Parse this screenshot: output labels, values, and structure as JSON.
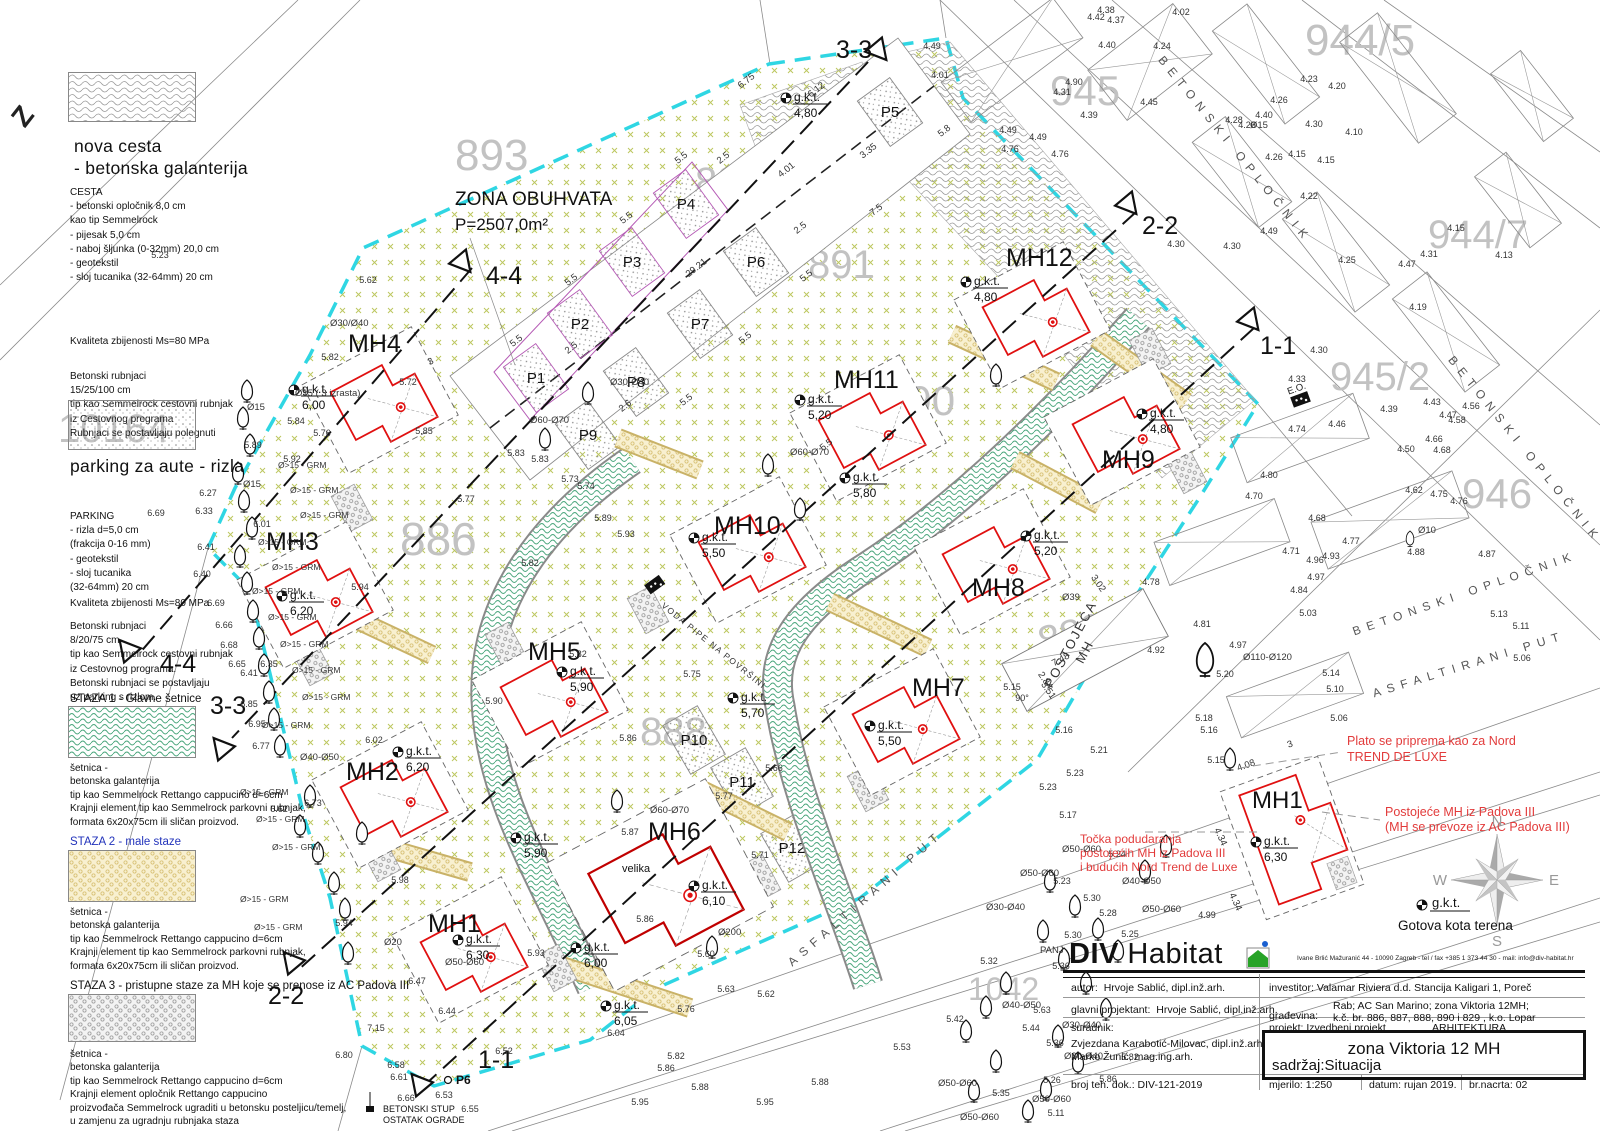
{
  "zone": {
    "line1": "ZONA OBUHVATA",
    "line2": "P=2507,0m²"
  },
  "legend": {
    "road_title_1": "nova cesta",
    "road_title_2": "- betonska galanterija",
    "cesta": [
      "CESTA",
      "- betonski opločnik 8,0 cm",
      "kao tip Semmelrock",
      "- pijesak 5,0 cm",
      "- naboj šljunka (0-32mm) 20,0 cm",
      "- geotekstil",
      "- sloj tucanika (32-64mm) 20 cm"
    ],
    "quality_road": "Kvaliteta zbijenosti Ms=80 MPa",
    "rubnjaci_road": [
      "Betonski rubnjaci",
      "15/25/100 cm",
      "tip kao Semmelrock cestovni rubnjak",
      "iz Cestovnog programa",
      "Rubnjaci se postavljaju polegnuti"
    ],
    "parking_title": "parking za aute - rizla",
    "parking": [
      "PARKING",
      "- rizla d=5,0 cm",
      "(frakcija 0-16 mm)",
      "- geotekstil",
      "- sloj tucanika",
      "(32-64mm) 20 cm"
    ],
    "quality_parking": "Kvaliteta zbijenosti Ms=80 MPa",
    "rubnjaci_parking": [
      "Betonski rubnjaci",
      "8/20/75 cm",
      "tip kao Semmelrock cestovni rubnjak",
      "iz Cestovnog programa.",
      "Betonski rubnjaci se postavljaju",
      "uz parking s rizlom."
    ],
    "staza1_title": "STAZA 1  - Glavne šetnice",
    "staza1": [
      "šetnica -",
      "betonska galanterija",
      "tip kao Semmelrock Rettango cappucino d=6cm",
      "Krajnji element tip kao Semmelrock parkovni rubnjak,",
      "formata 6x20x75cm ili sličan proizvod."
    ],
    "staza2_title": "STAZA 2 - male staze",
    "staza2": [
      "šetnica -",
      "betonska galanterija",
      "tip kao Semmelrock Rettango cappucino d=6cm",
      "Krajnji element tip kao Semmelrock parkovni rubnjak,",
      "formata 6x20x75cm ili sličan proizvod."
    ],
    "staza3_title": "STAZA 3 - pristupne staze za MH koje se prenose iz AC Padova III",
    "staza3": [
      "šetnica -",
      "betonska galanterija",
      "tip kao Semmelrock Rettango cappucino d=6cm",
      "Krajnji element opločnik Rettango cappucino",
      "proizvođača Semmelrock ugraditi u betonsku posteljicu/temelj,",
      "u zamjenu za ugradnju rubnjaka staza"
    ]
  },
  "mh_units": [
    {
      "label": "MH4",
      "gkt": "6,00"
    },
    {
      "label": "MH3",
      "gkt": "6,20"
    },
    {
      "label": "MH2",
      "gkt": "6,20"
    },
    {
      "label": "MH1",
      "gkt": "6,30"
    },
    {
      "label": "MH5",
      "gkt": "5,90"
    },
    {
      "label": "MH6",
      "gkt": "6,10",
      "note": "velika"
    },
    {
      "label": "MH10",
      "gkt": "5,50"
    },
    {
      "label": "MH11",
      "gkt": "5,20"
    },
    {
      "label": "MH12",
      "gkt": "4,80"
    },
    {
      "label": "MH9",
      "gkt": "4,80"
    },
    {
      "label": "MH8",
      "gkt": "5,20"
    },
    {
      "label": "MH7",
      "gkt": "5,50"
    }
  ],
  "detail": {
    "label": "MH1",
    "gkt": "6,30"
  },
  "gkt_label": "g.k.t.",
  "gkt_points": [
    [
      "4,80",
      786,
      98
    ],
    [
      "5,80",
      845,
      478
    ],
    [
      "5,70",
      733,
      698
    ],
    [
      "5,90",
      516,
      838
    ],
    [
      "6,00",
      576,
      948
    ],
    [
      "6,05",
      606,
      1006
    ],
    [
      "6,30",
      1256,
      842
    ]
  ],
  "parking_stalls": [
    "P1",
    "P2",
    "P3",
    "P4",
    "P5",
    "P6",
    "P7",
    "P8",
    "P9",
    "P10",
    "P11",
    "P12"
  ],
  "parcels": [
    [
      "893",
      455,
      170,
      44,
      0
    ],
    [
      "892",
      695,
      195,
      40,
      0
    ],
    [
      "891",
      808,
      278,
      40,
      0
    ],
    [
      "890",
      885,
      415,
      42,
      0
    ],
    [
      "886",
      400,
      555,
      46,
      0
    ],
    [
      "889",
      1042,
      655,
      40,
      -14
    ],
    [
      "888",
      640,
      745,
      40,
      0
    ],
    [
      "10164",
      58,
      442,
      40,
      0
    ],
    [
      "1042",
      968,
      1000,
      32,
      0
    ],
    [
      "944/5",
      1305,
      55,
      44,
      0
    ],
    [
      "945",
      1050,
      105,
      42,
      0
    ],
    [
      "945/2",
      1330,
      390,
      40,
      0
    ],
    [
      "944/7",
      1428,
      248,
      40,
      0
    ],
    [
      "946",
      1462,
      508,
      42,
      0
    ]
  ],
  "roads": {
    "betonski": "BETONSKI OPLOČNIK",
    "asfaltirani": "ASFALTIRANI PUT",
    "postojeca1": "POSTOJEĆA",
    "postojeca2": "MH"
  },
  "sections": {
    "s11": "1-1",
    "s22": "2-2",
    "s33": "3-3",
    "s44": "4-4"
  },
  "red_notes": {
    "plato1": "Plato se priprema kao za Nord",
    "plato2": "TREND DE LUXE",
    "post1": "Postojeće MH iz Padova III",
    "post2": "(MH se prevoze iz AC Padova III)",
    "tocka1": "Točka podudaranja",
    "tocka2": "postojećih MH iz Padova III",
    "tocka3": "i budućih Nord Trend de Luxe"
  },
  "misc": {
    "z": "Z",
    "voda": "VODA PIPE NA POVRŠINI",
    "eo": "E.O.",
    "stup1": "BETONSKI STUP",
    "stup2": "OSTATAK OGRADE",
    "p6": "P6",
    "gotova": "Gotova kota terena",
    "grm": "Ø>15 - GRM"
  },
  "compass": {
    "n": "N",
    "e": "E",
    "s": "S",
    "w": "W"
  },
  "titleblock": {
    "brand_bold": "DIV",
    "brand_light": "Habitat",
    "address": "Ivane Brlić Mažuranić 44 - 10090 Zagreb - tel / fax +385 1 373 44 30 - mail: info@div-habitat.hr",
    "autor_label": "autor:",
    "autor": "Hrvoje Sablić, dipl.inž.arh.",
    "investitor_label": "investitor:",
    "investitor": "Valamar Riviera d.d. Stancija Kaligari 1, Poreč",
    "gp_label": "glavni projektant:",
    "gp": "Hrvoje Sablić, dipl.inž.arh.",
    "gradjevina_label": "građevina:",
    "gradjevina1": "Rab; AC San Marino; zona Viktoria 12MH;",
    "gradjevina2": "k.č. br. 886, 887, 888, 890 i 829 , k.o.  Lopar",
    "suradnik_label": "suradnik:",
    "suradnik1": "Zvjezdana Karabotić-Milovac, dipl.inž.arh.",
    "suradnik2": "Marko Žunić, mag.ing.arh.",
    "projekt_label": "projekt: Izvedbeni projekt",
    "struka": "ARHITEKTURA",
    "naslov": "zona Viktoria 12 MH",
    "sadrzaj": "sadržaj:Situacija",
    "broj_label": "broj teh. dok.: DIV-121-2019",
    "mjerilo_label": "mjerilo:  1:250",
    "datum_label": "datum:  rujan  2019.",
    "nacrt_label": "br.nacrta:  02"
  },
  "spot_heights": [
    [
      "5.62",
      368,
      283
    ],
    [
      "5.82",
      330,
      360
    ],
    [
      "5.84",
      296,
      424
    ],
    [
      "5.72",
      408,
      385
    ],
    [
      "5.76",
      322,
      436
    ],
    [
      "5.85",
      424,
      434
    ],
    [
      "5.92",
      292,
      462
    ],
    [
      "5.89",
      253,
      448
    ],
    [
      "6.01",
      262,
      527
    ],
    [
      "6.27",
      208,
      496
    ],
    [
      "6.33",
      204,
      514
    ],
    [
      "6.69",
      156,
      516
    ],
    [
      "6.41",
      206,
      550
    ],
    [
      "6.40",
      202,
      577
    ],
    [
      "6.69",
      216,
      606
    ],
    [
      "6.66",
      224,
      628
    ],
    [
      "6.68",
      229,
      648
    ],
    [
      "6.65",
      237,
      667
    ],
    [
      "6.35",
      269,
      667
    ],
    [
      "6.41",
      249,
      676
    ],
    [
      "6.85",
      249,
      707
    ],
    [
      "6.95",
      257,
      727
    ],
    [
      "6.77",
      261,
      749
    ],
    [
      "6.62",
      279,
      812
    ],
    [
      "6.73",
      313,
      806
    ],
    [
      "6.02",
      374,
      743
    ],
    [
      "5.98",
      400,
      883
    ],
    [
      "5.94",
      360,
      590
    ],
    [
      "5.83",
      516,
      456
    ],
    [
      "5.83",
      540,
      462
    ],
    [
      "5.73",
      570,
      482
    ],
    [
      "5.74",
      586,
      489
    ],
    [
      "5.89",
      603,
      521
    ],
    [
      "5.93",
      626,
      537
    ],
    [
      "5.77",
      466,
      502
    ],
    [
      "5.82",
      530,
      566
    ],
    [
      "5.90",
      494,
      704
    ],
    [
      "5.82",
      578,
      657
    ],
    [
      "5.75",
      692,
      677
    ],
    [
      "5.86",
      628,
      741
    ],
    [
      "5.66",
      774,
      771
    ],
    [
      "5.77",
      724,
      799
    ],
    [
      "5.94",
      344,
      926
    ],
    [
      "6.47",
      417,
      984
    ],
    [
      "6.44",
      447,
      1014
    ],
    [
      "7.15",
      376,
      1031
    ],
    [
      "6.80",
      344,
      1058
    ],
    [
      "6.58",
      396,
      1068
    ],
    [
      "6.61",
      399,
      1080
    ],
    [
      "6.66",
      406,
      1101
    ],
    [
      "6.53",
      444,
      1098
    ],
    [
      "6.55",
      470,
      1112
    ],
    [
      "6.04",
      616,
      1036
    ],
    [
      "6.52",
      504,
      1054
    ],
    [
      "5.93",
      536,
      956
    ],
    [
      "5.86",
      645,
      922
    ],
    [
      "5.87",
      630,
      835
    ],
    [
      "5.71",
      760,
      858
    ],
    [
      "5.60",
      706,
      957
    ],
    [
      "5.63",
      726,
      992
    ],
    [
      "5.62",
      766,
      997
    ],
    [
      "5.76",
      686,
      1012
    ],
    [
      "5.82",
      676,
      1059
    ],
    [
      "5.86",
      666,
      1071
    ],
    [
      "5.88",
      700,
      1090
    ],
    [
      "5.95",
      640,
      1105
    ],
    [
      "5.23",
      1062,
      884
    ],
    [
      "5.30",
      1092,
      901
    ],
    [
      "5.28",
      1108,
      916
    ],
    [
      "5.25",
      1130,
      937
    ],
    [
      "5.30",
      1073,
      938
    ],
    [
      "5.36",
      1061,
      969
    ],
    [
      "4.99",
      1207,
      918
    ],
    [
      "5.32",
      989,
      964
    ],
    [
      "5.42",
      955,
      1022
    ],
    [
      "5.53",
      902,
      1050
    ],
    [
      "5.63",
      1042,
      1013
    ],
    [
      "5.44",
      1031,
      1031
    ],
    [
      "5.36",
      1055,
      1046
    ],
    [
      "5.26",
      1052,
      1083
    ],
    [
      "5.35",
      1001,
      1096
    ],
    [
      "5.11",
      1056,
      1116
    ],
    [
      "5.24",
      1117,
      857
    ],
    [
      "5.17",
      1068,
      818
    ],
    [
      "5.15",
      1012,
      690
    ],
    [
      "90°",
      1022,
      701
    ],
    [
      "5.16",
      1064,
      733
    ],
    [
      "5.16",
      1209,
      733
    ],
    [
      "5.18",
      1204,
      721
    ],
    [
      "5.21",
      1099,
      753
    ],
    [
      "5.23",
      1075,
      776
    ],
    [
      "5.23",
      1048,
      790
    ],
    [
      "5.15",
      1216,
      763
    ],
    [
      "5.13",
      1499,
      617
    ],
    [
      "5.11",
      1521,
      629
    ],
    [
      "5.06",
      1522,
      661
    ],
    [
      "5.14",
      1331,
      676
    ],
    [
      "5.10",
      1335,
      692
    ],
    [
      "5.06",
      1339,
      721
    ],
    [
      "5.03",
      1308,
      616
    ],
    [
      "4.84",
      1299,
      593
    ],
    [
      "4.97",
      1316,
      580
    ],
    [
      "4.93",
      1331,
      559
    ],
    [
      "4.96",
      1315,
      563
    ],
    [
      "4.81",
      1202,
      627
    ],
    [
      "4.97",
      1238,
      648
    ],
    [
      "5.20",
      1225,
      677
    ],
    [
      "4.92",
      1156,
      653
    ],
    [
      "4.78",
      1151,
      585
    ],
    [
      "4.71",
      1291,
      554
    ],
    [
      "4.68",
      1317,
      521
    ],
    [
      "4.77",
      1351,
      544
    ],
    [
      "4.80",
      1269,
      478
    ],
    [
      "4.70",
      1254,
      499
    ],
    [
      "4.87",
      1487,
      557
    ],
    [
      "4.88",
      1416,
      555
    ],
    [
      "4.75",
      1439,
      497
    ],
    [
      "4.76",
      1459,
      504
    ],
    [
      "4.62",
      1414,
      493
    ],
    [
      "4.50",
      1406,
      452
    ],
    [
      "4.66",
      1434,
      442
    ],
    [
      "4.68",
      1442,
      453
    ],
    [
      "4.56",
      1471,
      409
    ],
    [
      "4.58",
      1457,
      423
    ],
    [
      "4.39",
      1389,
      412
    ],
    [
      "4.74",
      1297,
      432
    ],
    [
      "4.46",
      1337,
      427
    ],
    [
      "4.33",
      1297,
      382
    ],
    [
      "4.30",
      1319,
      353
    ],
    [
      "4.02",
      1181,
      15
    ],
    [
      "4.24",
      1162,
      49
    ],
    [
      "4.23",
      1309,
      82
    ],
    [
      "4.20",
      1337,
      89
    ],
    [
      "4.30",
      1314,
      127
    ],
    [
      "4.10",
      1354,
      135
    ],
    [
      "4.15",
      1326,
      163
    ],
    [
      "4.22",
      1309,
      199
    ],
    [
      "4.40",
      1264,
      118
    ],
    [
      "4.28",
      1234,
      123
    ],
    [
      "4.26",
      1279,
      103
    ],
    [
      "4.26",
      1274,
      160
    ],
    [
      "4.49",
      1269,
      234
    ],
    [
      "4.30",
      1232,
      249
    ],
    [
      "4.25",
      1347,
      263
    ],
    [
      "4.47",
      1407,
      267
    ],
    [
      "4.15",
      1456,
      231
    ],
    [
      "4.13",
      1504,
      258
    ],
    [
      "4.31",
      1429,
      257
    ],
    [
      "4.49",
      932,
      49
    ],
    [
      "4.01",
      940,
      78
    ],
    [
      "4.90",
      1074,
      85
    ],
    [
      "4.31",
      1062,
      95
    ],
    [
      "4.40",
      1107,
      48
    ],
    [
      "4.42",
      1096,
      20
    ],
    [
      "4.38",
      1106,
      13
    ],
    [
      "4.37",
      1116,
      23
    ],
    [
      "4.45",
      1149,
      105
    ],
    [
      "4.39",
      1089,
      118
    ],
    [
      "4.49",
      1038,
      140
    ],
    [
      "4.76",
      1060,
      157
    ],
    [
      "4.49",
      1008,
      133
    ],
    [
      "4.76",
      1010,
      152
    ],
    [
      "4.26",
      1247,
      128
    ],
    [
      "4.15",
      1297,
      157
    ],
    [
      "4.19",
      1418,
      310
    ],
    [
      "4.43",
      1432,
      405
    ],
    [
      "4.47",
      1448,
      418
    ],
    [
      "4.30",
      1176,
      247
    ],
    [
      "5.82",
      1130,
      1060
    ],
    [
      "5.86",
      1108,
      1082
    ],
    [
      "5.88",
      820,
      1085
    ],
    [
      "5.95",
      765,
      1105
    ],
    [
      "5.23",
      160,
      258
    ]
  ],
  "dims": [
    [
      "6.75",
      748,
      83,
      -38
    ],
    [
      "5.5",
      683,
      160,
      -38
    ],
    [
      "5.5",
      628,
      220,
      -38
    ],
    [
      "5.5",
      573,
      282,
      -38
    ],
    [
      "5.5",
      518,
      343,
      -38
    ],
    [
      "5.5",
      808,
      278,
      -38
    ],
    [
      "5.5",
      747,
      340,
      -38
    ],
    [
      "5.5",
      688,
      402,
      -38
    ],
    [
      "5.5",
      828,
      447,
      -38
    ],
    [
      "7.5",
      878,
      212,
      -38
    ],
    [
      "6.12",
      818,
      92,
      -38
    ],
    [
      "3.35",
      870,
      153,
      -38
    ],
    [
      "4.01",
      788,
      172,
      -38
    ],
    [
      "2.5",
      725,
      160,
      -38
    ],
    [
      "2.5",
      802,
      230,
      -38
    ],
    [
      "2.5",
      573,
      350,
      -38
    ],
    [
      "2.6",
      627,
      408,
      -38
    ],
    [
      "29.21",
      698,
      270,
      -38
    ],
    [
      "5.8",
      946,
      133,
      -38
    ],
    [
      "2.84",
      1043,
      682,
      55
    ],
    [
      "3.02",
      1096,
      585,
      55
    ],
    [
      "3.51",
      1046,
      692,
      55
    ],
    [
      "7.48",
      1062,
      662,
      -28
    ],
    [
      "4.08",
      1247,
      768,
      -20
    ],
    [
      "3",
      1291,
      747,
      -20
    ],
    [
      "4.34",
      1218,
      838,
      65
    ],
    [
      "4.34",
      1233,
      903,
      65
    ],
    [
      "3",
      432,
      364,
      -28
    ]
  ],
  "tree_labels": [
    [
      "Ø30/Ø40",
      330,
      326
    ],
    [
      "Ø15 ( 3 izrasta)",
      295,
      396
    ],
    [
      "Ø15",
      247,
      410
    ],
    [
      "Ø15",
      243,
      487
    ],
    [
      "Ø30-Ø40",
      610,
      385
    ],
    [
      "Ø60-Ø70",
      790,
      455
    ],
    [
      "Ø60-Ø70",
      530,
      423
    ],
    [
      "Ø50-Ø60",
      445,
      965
    ],
    [
      "Ø20",
      384,
      945
    ],
    [
      "Ø200",
      718,
      935
    ],
    [
      "Ø60-Ø70",
      650,
      813
    ],
    [
      "Ø50-Ø60",
      1062,
      852
    ],
    [
      "Ø40-Ø50",
      1122,
      884
    ],
    [
      "Ø50-Ø60",
      1142,
      912
    ],
    [
      "Ø50-Ø60",
      1020,
      876
    ],
    [
      "Ø30-Ø40",
      986,
      910
    ],
    [
      "Ø40-Ø50",
      1002,
      1008
    ],
    [
      "Ø30-Ø40",
      1062,
      1028
    ],
    [
      "Ø30-Ø40",
      1064,
      1059
    ],
    [
      "Ø50-Ø60",
      938,
      1086
    ],
    [
      "Ø50-Ø60",
      1032,
      1102
    ],
    [
      "PANJ",
      1040,
      953
    ],
    [
      "Ø110-Ø120",
      1243,
      660
    ],
    [
      "Ø10",
      1418,
      533
    ],
    [
      "Ø15",
      1250,
      128
    ],
    [
      "Ø39",
      1062,
      600
    ],
    [
      "Ø40-Ø50",
      300,
      760
    ],
    [
      "Ø50-Ø60",
      960,
      1120
    ]
  ],
  "grm_positions": [
    [
      278,
      468
    ],
    [
      290,
      493
    ],
    [
      300,
      518
    ],
    [
      258,
      545
    ],
    [
      272,
      570
    ],
    [
      252,
      594
    ],
    [
      268,
      620
    ],
    [
      280,
      647
    ],
    [
      292,
      673
    ],
    [
      302,
      700
    ],
    [
      262,
      728
    ],
    [
      240,
      795
    ],
    [
      256,
      822
    ],
    [
      272,
      850
    ],
    [
      240,
      902
    ],
    [
      254,
      930
    ]
  ]
}
